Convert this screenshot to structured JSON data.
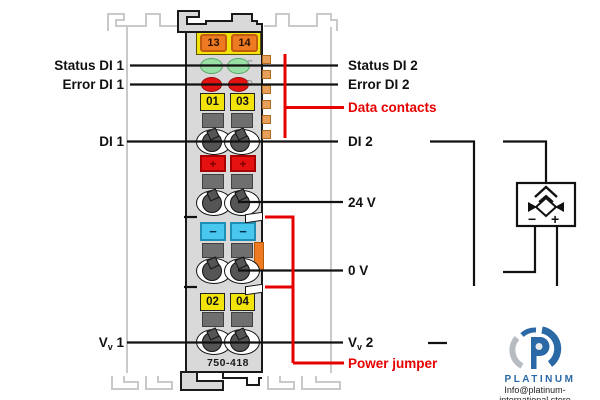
{
  "device": {
    "model": "750-418",
    "top_terminals": [
      "13",
      "14"
    ],
    "upper_terminals": [
      "01",
      "03"
    ],
    "lower_terminals": [
      "02",
      "04"
    ],
    "plus": "+",
    "minus": "−",
    "led_marks": [
      "C",
      "D"
    ]
  },
  "labels": {
    "left": {
      "status": "Status DI 1",
      "error": "Error DI 1",
      "di": "DI 1",
      "vv": {
        "main": "V",
        "sub": "v",
        "num": " 1"
      }
    },
    "right": {
      "status": "Status DI 2",
      "error": "Error DI 2",
      "data_contacts": "Data contacts",
      "di": "DI 2",
      "supply_24v": "24 V",
      "supply_0v": "0 V",
      "vv": {
        "main": "V",
        "sub": "v",
        "num": " 2"
      },
      "power_jumper": "Power jumper"
    }
  },
  "sensor": {
    "minus": "−",
    "plus": "+"
  },
  "watermark": {
    "brand": "PLATINUM",
    "email": "Info@platinum-international.store"
  },
  "colors": {
    "accent_red": "#e60000",
    "wago_yellow": "#f2e30a",
    "contact_orange": "#ee7b22",
    "led_green": "#98e0a6",
    "led_red": "#e21212",
    "clamp_blue": "#49c7ef",
    "brand_blue": "#2a69a5"
  }
}
